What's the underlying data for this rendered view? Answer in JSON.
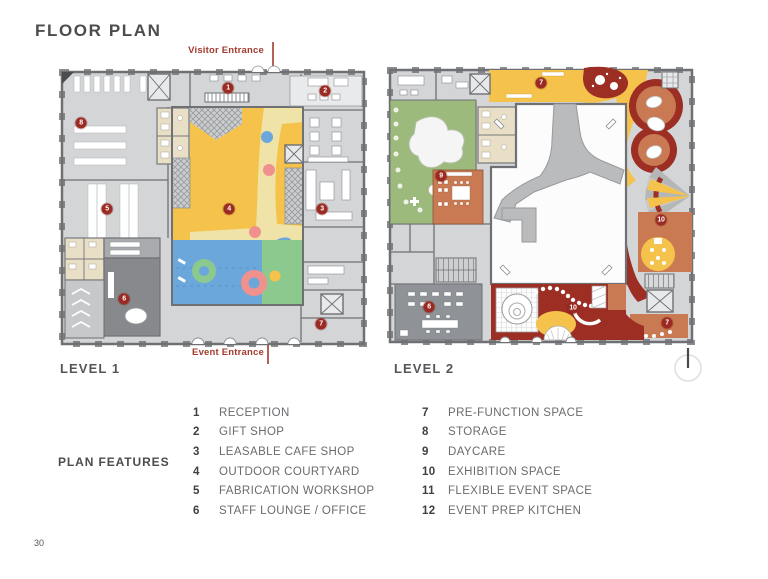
{
  "page": {
    "title": "FLOOR PLAN",
    "page_number": "30"
  },
  "plans": [
    {
      "label": "LEVEL 1",
      "entrance_top": "Visitor Entrance",
      "entrance_bottom": "Event Entrance",
      "badges": [
        {
          "n": "1"
        },
        {
          "n": "2"
        },
        {
          "n": "3"
        },
        {
          "n": "4"
        },
        {
          "n": "5"
        },
        {
          "n": "6"
        },
        {
          "n": "7"
        },
        {
          "n": "8"
        }
      ]
    },
    {
      "label": "LEVEL 2",
      "badges": [
        {
          "n": "7"
        },
        {
          "n": "9"
        },
        {
          "n": "10"
        },
        {
          "n": "10"
        },
        {
          "n": "6"
        },
        {
          "n": "7"
        }
      ]
    }
  ],
  "legend": {
    "heading": "PLAN FEATURES",
    "columns": [
      {
        "items": [
          {
            "num": "1",
            "label": "RECEPTION"
          },
          {
            "num": "2",
            "label": "GIFT SHOP"
          },
          {
            "num": "3",
            "label": "LEASABLE CAFE SHOP"
          },
          {
            "num": "4",
            "label": "OUTDOOR COURTYARD"
          },
          {
            "num": "5",
            "label": "FABRICATION WORKSHOP"
          },
          {
            "num": "6",
            "label": "STAFF LOUNGE / OFFICE"
          }
        ]
      },
      {
        "items": [
          {
            "num": "7",
            "label": "PRE-FUNCTION SPACE"
          },
          {
            "num": "8",
            "label": "STORAGE"
          },
          {
            "num": "9",
            "label": "DAYCARE"
          },
          {
            "num": "10",
            "label": "EXHIBITION SPACE"
          },
          {
            "num": "11",
            "label": "FLEXIBLE EVENT SPACE"
          },
          {
            "num": "12",
            "label": "EVENT PREP KITCHEN"
          }
        ]
      }
    ]
  },
  "icons": {
    "compass": "north-arrow",
    "entrance_arrows": "red-arrow"
  },
  "colors": {
    "accent_red": "#A23B2E",
    "badge_red": "#9B2B22",
    "courtyard_yellow": "#F5C34B",
    "pale_yellow": "#EFE3A8",
    "play_blue": "#6BA7DB",
    "play_green": "#8CC98F",
    "play_pink": "#F0918E",
    "sage_green": "#9CBA7C",
    "terracotta": "#CA7A52",
    "dark_red": "#9C2E24",
    "restroom_beige": "#E9DFC6",
    "plan_gray": "#D3D5D7",
    "wall_gray": "#6E7073"
  }
}
